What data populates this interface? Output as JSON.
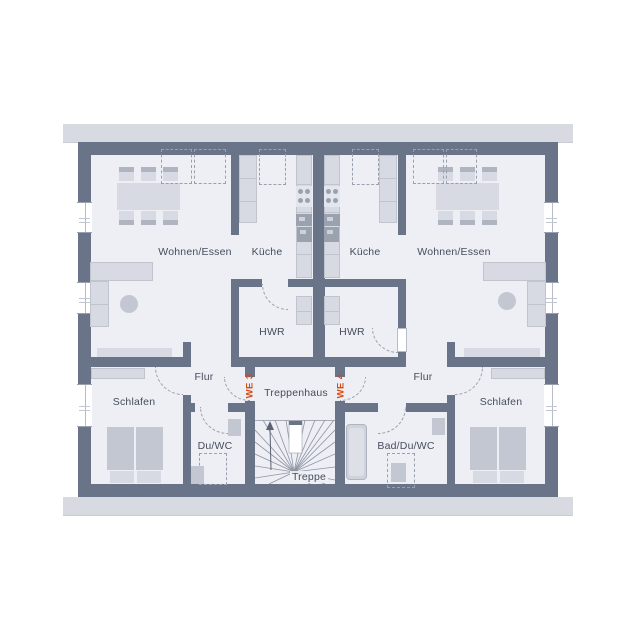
{
  "title": "Obergeschoss Grundriss",
  "labels": {
    "wohnen_left": "Wohnen/Essen",
    "kueche_left": "Küche",
    "kueche_right": "Küche",
    "wohnen_right": "Wohnen/Essen",
    "hwr_left": "HWR",
    "hwr_right": "HWR",
    "flur_left": "Flur",
    "flur_right": "Flur",
    "schlafen_left": "Schlafen",
    "schlafen_right": "Schlafen",
    "duwc": "Du/WC",
    "bad": "Bad/Du/WC",
    "treppenhaus": "Treppenhaus",
    "treppe": "Treppe",
    "we3": "WE 3",
    "we4": "WE 4"
  },
  "colors": {
    "wall": "#6a7488",
    "floor": "#edeff4",
    "furniture": "#d7dae2",
    "furniture_dark": "#c2c7d1",
    "appliance": "#9ba2af",
    "dash": "#9aa1ae",
    "eave": "#d8dae1",
    "label": "#454d5d",
    "accent": "#d9480f",
    "background": "#ffffff",
    "stair_line": "#8d94a2"
  }
}
